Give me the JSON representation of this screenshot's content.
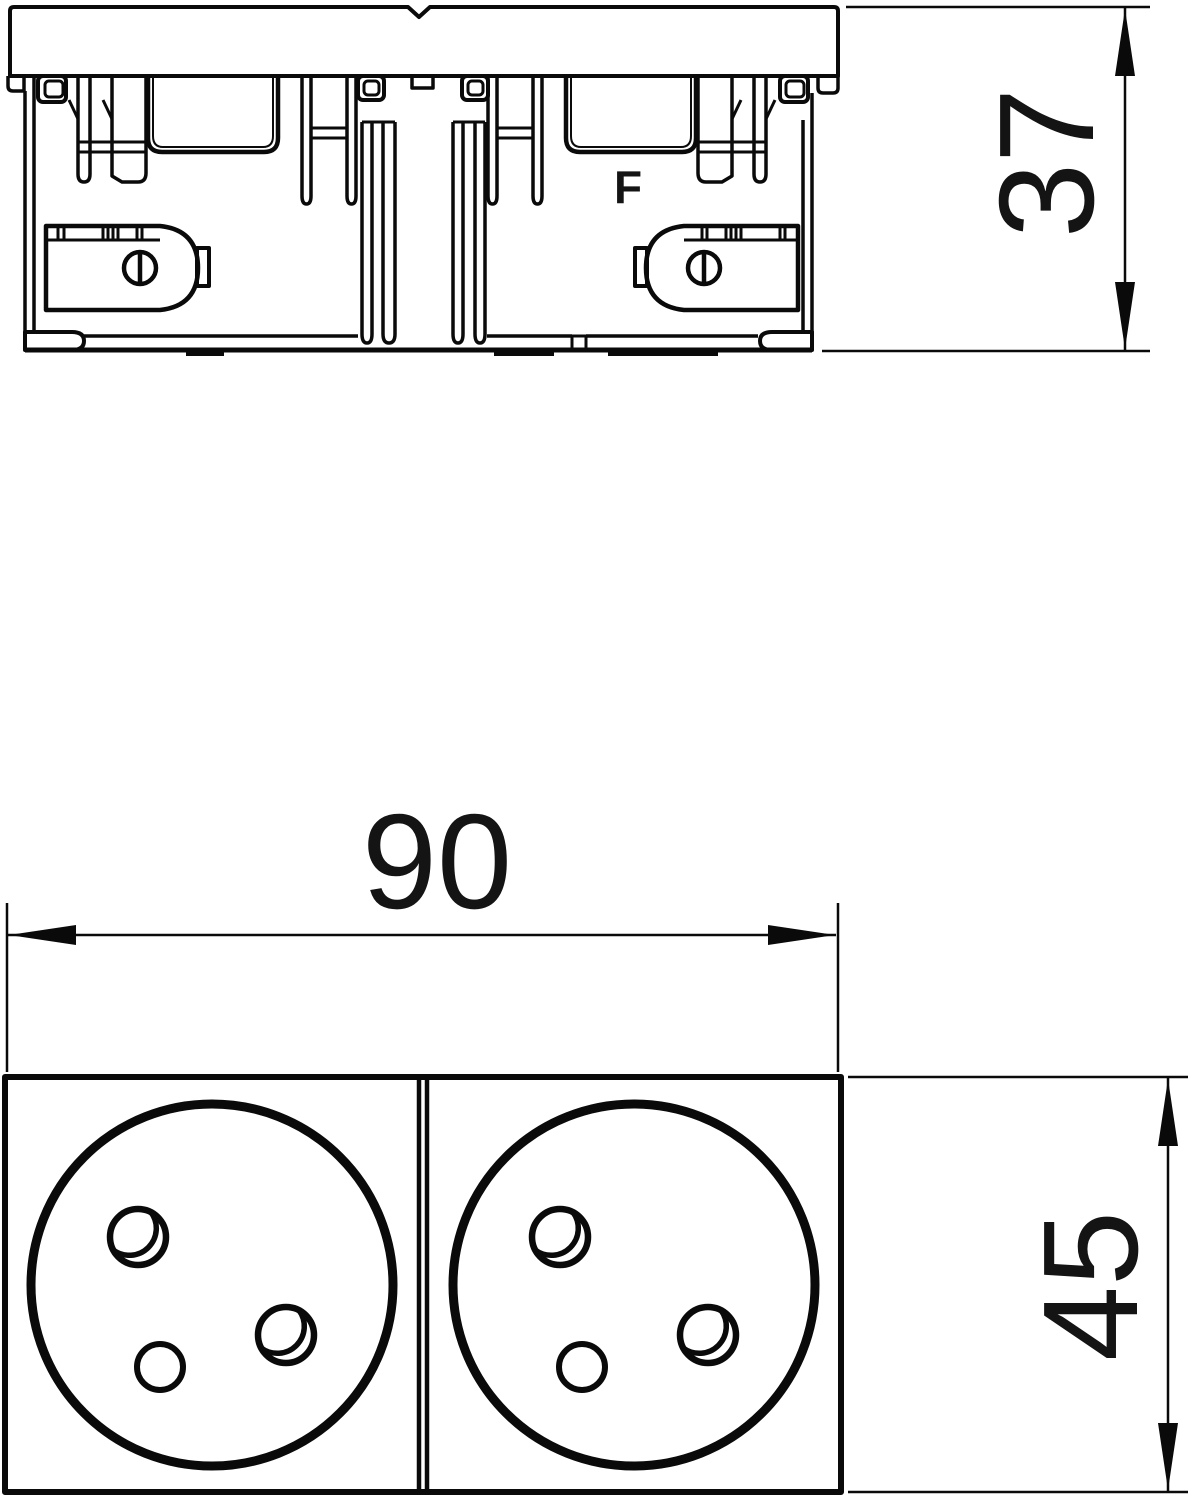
{
  "page": {
    "background": "#ffffff",
    "line_color": "#0a0a0a"
  },
  "drawing": {
    "type": "technical-drawing-two-views",
    "side_view": {
      "insert_label": "F",
      "height_dimension": "37"
    },
    "front_view": {
      "width_dimension": "90",
      "height_dimension": "45",
      "socket_count": 2
    }
  }
}
